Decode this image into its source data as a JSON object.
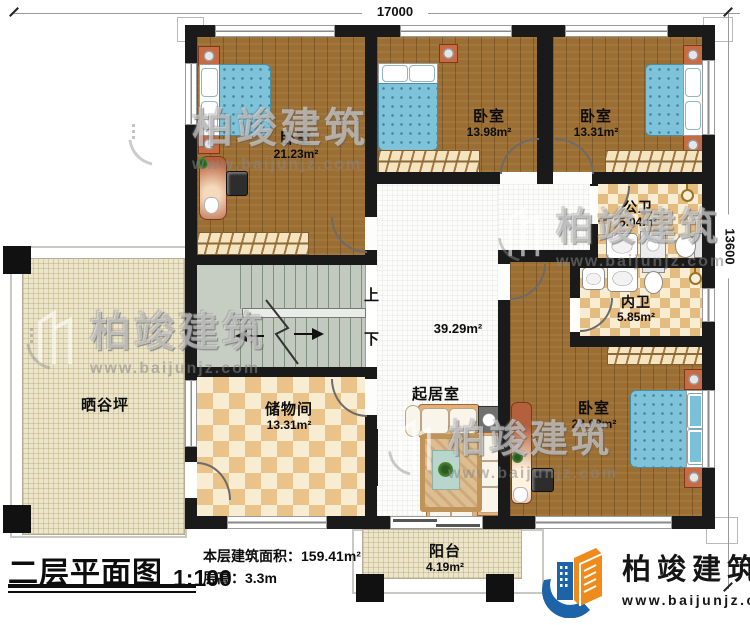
{
  "dimensions": {
    "width_mm": "17000",
    "height_mm": "13600"
  },
  "rooms": {
    "bedroom_tl": {
      "label": "卧室",
      "area": "21.23m²"
    },
    "bedroom_tm": {
      "label": "卧室",
      "area": "13.98m²"
    },
    "bedroom_tr": {
      "label": "卧室",
      "area": "13.31m²"
    },
    "public_bath": {
      "label": "公卫",
      "area": "5.04m²"
    },
    "private_bath": {
      "label": "内卫",
      "area": "5.85m²"
    },
    "bedroom_br": {
      "label": "卧室",
      "area": "23.08m²"
    },
    "living": {
      "label": "起居室",
      "area": "39.29m²"
    },
    "storage": {
      "label": "储物间",
      "area": "13.31m²"
    },
    "terrace": {
      "label": "晒谷坪"
    },
    "balcony": {
      "label": "阳台",
      "area": "4.19m²"
    }
  },
  "stairs": {
    "up": "上",
    "down": "下"
  },
  "title_block": {
    "name": "二层平面图",
    "scale": "1:100",
    "floor_area_label": "本层建筑面积：",
    "floor_area_value": "159.41m²",
    "floor_height_label": "层高：",
    "floor_height_value": "3.3m"
  },
  "logo": {
    "company": "柏竣建筑",
    "website": "www.baijunjz.com"
  },
  "watermark": {
    "company": "柏竣建筑",
    "website": "www.baijunjz.com"
  }
}
